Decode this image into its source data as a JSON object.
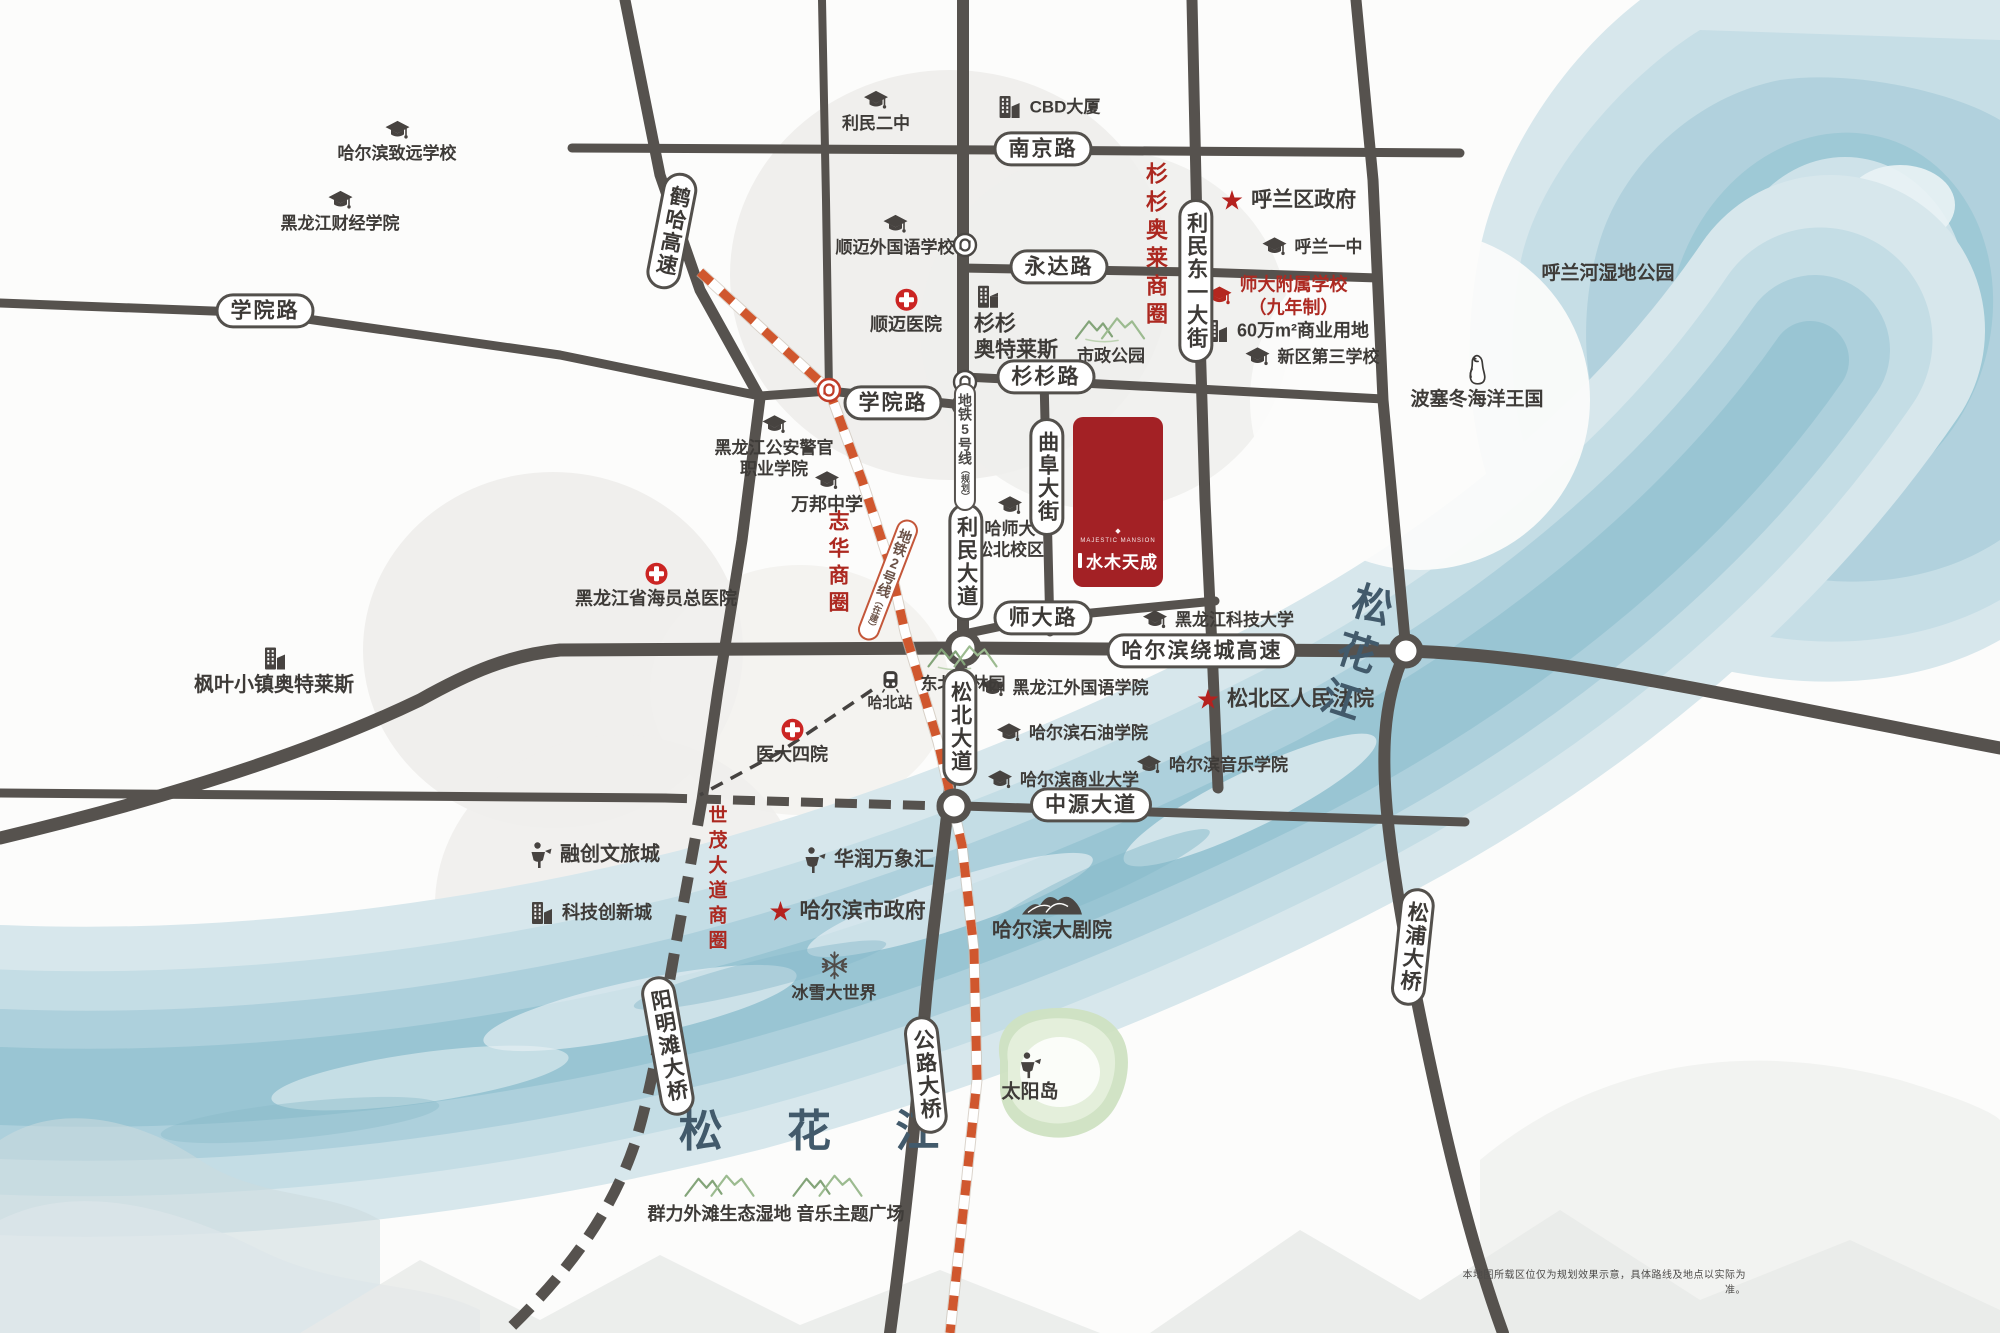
{
  "property": {
    "name": "水木天成",
    "tagline": "MAJESTIC MANSION",
    "ornament": "◆"
  },
  "disclaimer": "本地图所载区位仅为规划效果示意，具体路线及地点以实际为准。",
  "colors": {
    "road": "#56524e",
    "accent_red": "#a32125",
    "metro2": "#d0572e",
    "river": "#a9cdd8",
    "green": "#8aa87e"
  },
  "road_labels": [
    {
      "name": "nanjing-road",
      "label": "南京路",
      "x": 1043,
      "y": 149,
      "v": false,
      "rot": 0
    },
    {
      "name": "yongda-road",
      "label": "永达路",
      "x": 1059,
      "y": 267,
      "v": false,
      "rot": 0
    },
    {
      "name": "shanshan-road",
      "label": "杉杉路",
      "x": 1046,
      "y": 377,
      "v": false,
      "rot": 0
    },
    {
      "name": "xueyuan-road-west",
      "label": "学院路",
      "x": 265,
      "y": 311,
      "v": false,
      "rot": 0
    },
    {
      "name": "xueyuan-road-east",
      "label": "学院路",
      "x": 893,
      "y": 403,
      "v": false,
      "rot": 0
    },
    {
      "name": "shida-road",
      "label": "师大路",
      "x": 1043,
      "y": 618,
      "v": false,
      "rot": 0
    },
    {
      "name": "ring-expressway",
      "label": "哈尔滨绕城高速",
      "x": 1202,
      "y": 651,
      "v": false,
      "rot": 0
    },
    {
      "name": "zhongyuan-avenue",
      "label": "中源大道",
      "x": 1091,
      "y": 805,
      "v": false,
      "rot": 0
    },
    {
      "name": "heha-expressway",
      "label": "鹤哈高速",
      "x": 672,
      "y": 231,
      "v": true,
      "rot": 11
    },
    {
      "name": "limindong-first-street",
      "label": "利民东一大街",
      "x": 1196,
      "y": 281,
      "v": true,
      "rot": 0
    },
    {
      "name": "qufu-street",
      "label": "曲阜大街",
      "x": 1047,
      "y": 477,
      "v": true,
      "rot": 0
    },
    {
      "name": "limin-avenue",
      "label": "利民大道",
      "x": 966,
      "y": 562,
      "v": true,
      "rot": 0
    },
    {
      "name": "songbei-avenue",
      "label": "松北大道",
      "x": 960,
      "y": 727,
      "v": true,
      "rot": 0
    },
    {
      "name": "yangmingtan-bridge",
      "label": "阳明滩大桥",
      "x": 668,
      "y": 1046,
      "v": true,
      "rot": -10
    },
    {
      "name": "gonglu-bridge",
      "label": "公路大桥",
      "x": 926,
      "y": 1075,
      "v": true,
      "rot": -6
    },
    {
      "name": "songpu-bridge",
      "label": "松浦大桥",
      "x": 1413,
      "y": 947,
      "v": true,
      "rot": 6
    }
  ],
  "metro_labels": [
    {
      "name": "metro-line5-label",
      "label": "地铁5号线",
      "sub": "（规划）",
      "x": 965,
      "y": 447,
      "rot": 0,
      "color": "#4c4a48",
      "border": "#57534f"
    },
    {
      "name": "metro-line2-label",
      "label": "地铁2号线",
      "sub": "（在建）",
      "x": 888,
      "y": 580,
      "rot": 21,
      "color": "#6b5247",
      "border": "#c4573a"
    }
  ],
  "business_circles": [
    {
      "name": "shanshan-outlet-circle",
      "label": "杉杉奥莱商圈",
      "x": 1155,
      "y": 246,
      "size": 22
    },
    {
      "name": "zhihua-circle",
      "label": "志华商圈",
      "x": 837,
      "y": 564,
      "size": 21
    },
    {
      "name": "shimao-avenue-circle",
      "label": "世茂大道商圈",
      "x": 716,
      "y": 880,
      "size": 19
    }
  ],
  "water_labels": [
    {
      "name": "songhua-river-bottom",
      "label": "松 花 江",
      "x": 822,
      "y": 1127,
      "size": 44,
      "rot": 0,
      "v": false,
      "ls": 26
    },
    {
      "name": "songhua-river-right",
      "label": "松花江",
      "x": 1352,
      "y": 655,
      "size": 40,
      "rot": 18,
      "v": true,
      "ls": 10
    }
  ],
  "pois": [
    {
      "name": "harbin-zhiyuan-school",
      "icon": "cap",
      "layout": "col",
      "x": 397,
      "y": 142,
      "label": "哈尔滨致远学校",
      "size": 17
    },
    {
      "name": "heilongjiang-finance-college",
      "icon": "cap",
      "layout": "col",
      "x": 340,
      "y": 212,
      "label": "黑龙江财经学院",
      "size": 17
    },
    {
      "name": "limin-no2-middle-school",
      "icon": "cap",
      "layout": "col",
      "x": 876,
      "y": 112,
      "label": "利民二中",
      "size": 17
    },
    {
      "name": "shunmai-foreign-language-school",
      "icon": "cap",
      "layout": "col",
      "x": 895,
      "y": 236,
      "label": "顺迈外国语学校",
      "size": 17
    },
    {
      "name": "police-officer-vocational-college",
      "icon": "cap",
      "layout": "col",
      "x": 774,
      "y": 447,
      "lines": [
        "黑龙江公安警官",
        "职业学院"
      ],
      "size": 17
    },
    {
      "name": "wanbang-middle-school",
      "icon": "cap",
      "layout": "col",
      "x": 827,
      "y": 493,
      "label": "万邦中学",
      "size": 18
    },
    {
      "name": "hulan-no1-middle-school",
      "icon": "cap",
      "layout": "row",
      "x": 1312,
      "y": 247,
      "label": "呼兰一中",
      "size": 17
    },
    {
      "name": "shida-affiliated-school",
      "icon": "cap-red",
      "layout": "row",
      "x": 1277,
      "y": 296,
      "lines": [
        "师大附属学校",
        "（九年制）"
      ],
      "size": 18,
      "color": "#ad2a22"
    },
    {
      "name": "xinqu-no3-school",
      "icon": "cap",
      "layout": "row",
      "x": 1312,
      "y": 357,
      "label": "新区第三学校",
      "size": 17
    },
    {
      "name": "hashida-songbei-campus",
      "icon": "cap",
      "layout": "col",
      "x": 1010,
      "y": 528,
      "lines": [
        "哈师大",
        "松北校区"
      ],
      "size": 17
    },
    {
      "name": "heilongjiang-foreign-studies-college",
      "icon": "cap",
      "layout": "row",
      "x": 1064,
      "y": 688,
      "label": "黑龙江外国语学院",
      "size": 17
    },
    {
      "name": "harbin-petroleum-institute",
      "icon": "cap",
      "layout": "row",
      "x": 1072,
      "y": 733,
      "label": "哈尔滨石油学院",
      "size": 17
    },
    {
      "name": "harbin-music-conservatory",
      "icon": "cap",
      "layout": "row",
      "x": 1212,
      "y": 765,
      "label": "哈尔滨音乐学院",
      "size": 17
    },
    {
      "name": "harbin-commerce-university",
      "icon": "cap",
      "layout": "row",
      "x": 1063,
      "y": 780,
      "label": "哈尔滨商业大学",
      "size": 17
    },
    {
      "name": "heilongjiang-sci-tech-university",
      "icon": "cap",
      "layout": "row",
      "x": 1218,
      "y": 620,
      "label": "黑龙江科技大学",
      "size": 17
    },
    {
      "name": "shunmai-hospital",
      "icon": "cross",
      "layout": "col",
      "x": 906,
      "y": 312,
      "label": "顺迈医院",
      "size": 18
    },
    {
      "name": "seamen-general-hospital",
      "icon": "cross",
      "layout": "col",
      "x": 656,
      "y": 586,
      "label": "黑龙江省海员总医院",
      "size": 18
    },
    {
      "name": "yida-no4-hospital",
      "icon": "cross",
      "layout": "col",
      "x": 792,
      "y": 742,
      "label": "医大四院",
      "size": 18
    },
    {
      "name": "hulan-district-government",
      "icon": "star",
      "layout": "row",
      "x": 1288,
      "y": 201,
      "label": "呼兰区政府",
      "size": 21
    },
    {
      "name": "songbei-peoples-court",
      "icon": "star",
      "layout": "row",
      "x": 1285,
      "y": 700,
      "label": "松北区人民法院",
      "size": 21
    },
    {
      "name": "harbin-city-government",
      "icon": "star",
      "layout": "row",
      "x": 847,
      "y": 912,
      "label": "哈尔滨市政府",
      "size": 21
    },
    {
      "name": "cbd-tower",
      "icon": "building",
      "layout": "row",
      "x": 1048,
      "y": 107,
      "label": "CBD大厦",
      "size": 17
    },
    {
      "name": "shanshan-outlets",
      "icon": "building",
      "layout": "col-left",
      "x": 1016,
      "y": 324,
      "lines": [
        "杉杉",
        "奥特莱斯"
      ],
      "size": 21
    },
    {
      "name": "commercial-land-600k",
      "icon": "building",
      "layout": "row",
      "x": 1286,
      "y": 331,
      "label": "60万m²商业用地",
      "size": 18
    },
    {
      "name": "tech-innovation-city",
      "icon": "building",
      "layout": "row",
      "x": 590,
      "y": 913,
      "label": "科技创新城",
      "size": 18
    },
    {
      "name": "fengye-town-outlets",
      "icon": "building",
      "layout": "col",
      "x": 274,
      "y": 672,
      "label": "枫叶小镇奥特莱斯",
      "size": 20
    },
    {
      "name": "rongchuang-culture-tourism-city",
      "icon": "ride",
      "layout": "row",
      "x": 594,
      "y": 855,
      "label": "融创文旅城",
      "size": 20
    },
    {
      "name": "huarun-mixc",
      "icon": "ride",
      "layout": "row",
      "x": 868,
      "y": 860,
      "label": "华润万象汇",
      "size": 20
    },
    {
      "name": "sun-island",
      "icon": "ride",
      "layout": "col",
      "x": 1030,
      "y": 1078,
      "label": "太阳岛",
      "size": 19
    },
    {
      "name": "shizheng-park",
      "icon": "mountains",
      "layout": "col",
      "x": 1111,
      "y": 340,
      "label": "市政公园",
      "size": 17
    },
    {
      "name": "dongbei-tiger-park",
      "icon": "mountains",
      "layout": "col",
      "x": 963,
      "y": 668,
      "label": "东北虎林园",
      "size": 17
    },
    {
      "name": "qunli-wetland-music-plaza",
      "icon": "mountains-wide",
      "layout": "col",
      "x": 776,
      "y": 1198,
      "label": "群力外滩生态湿地 音乐主题广场",
      "size": 18
    },
    {
      "name": "harbin-grand-theatre",
      "icon": "opera",
      "layout": "col",
      "x": 1052,
      "y": 916,
      "label": "哈尔滨大剧院",
      "size": 20
    },
    {
      "name": "ice-snow-world",
      "icon": "snow",
      "layout": "col",
      "x": 834,
      "y": 977,
      "label": "冰雪大世界",
      "size": 17
    },
    {
      "name": "poseidon-ocean-kingdom",
      "icon": "penguin",
      "layout": "col",
      "x": 1477,
      "y": 383,
      "label": "波塞冬海洋王国",
      "size": 19
    },
    {
      "name": "hulanhe-wetland-park",
      "icon": null,
      "layout": "col",
      "x": 1608,
      "y": 274,
      "label": "呼兰河湿地公园",
      "size": 19
    },
    {
      "name": "habei-station",
      "icon": "train",
      "layout": "col",
      "x": 890,
      "y": 691,
      "label": "哈北站",
      "size": 15
    }
  ]
}
